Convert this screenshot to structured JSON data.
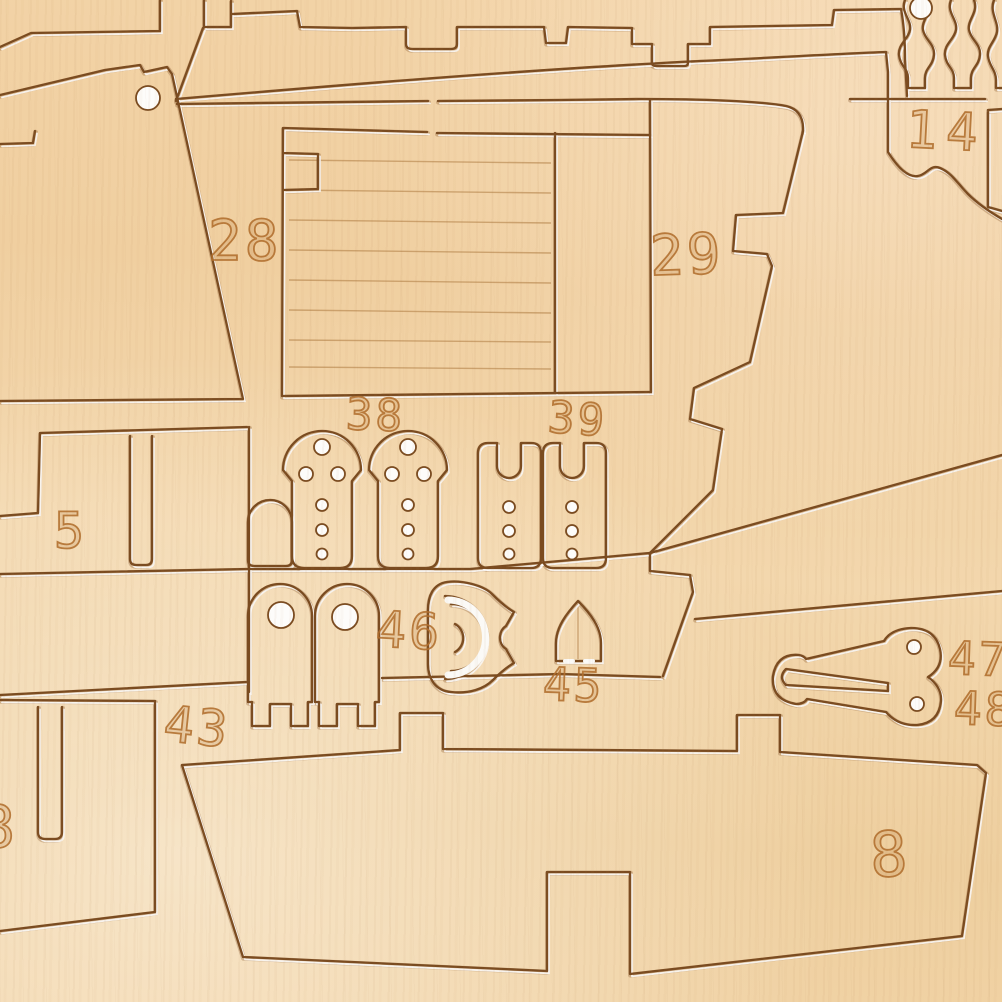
{
  "scene": {
    "description": "Close-up photograph of a laser-cut plywood model ship kit sheet with numbered press-out parts",
    "material": "light birch plywood sheet",
    "colors": {
      "wood": "#f0d1a2",
      "kerf_line": "#7a4b20",
      "kerf_glint": "#ffffff",
      "engraved_number": "#b1702d"
    },
    "features": [
      "finger-jointed deck strips along top edge",
      "planked bulkhead rectangle with scored plank lines",
      "keyhole-shaped parts with pilot holes (38)",
      "slotted rectangular parts with pilot holes (39)",
      "arched parts with large holes",
      "horseshoe-shaped part (46)",
      "pointed-arch part (45)",
      "cleat-shaped part with two holes (47)",
      "large ship deck part with tabs and slot (8)",
      "turned baluster-profile parts at top right"
    ]
  },
  "labels": [
    {
      "part": "part-28",
      "text": "28"
    },
    {
      "part": "part-29",
      "text": "29"
    },
    {
      "part": "part-14",
      "text": "14"
    },
    {
      "part": "part-38",
      "text": "38"
    },
    {
      "part": "part-39",
      "text": "39"
    },
    {
      "part": "part-5",
      "text": "5"
    },
    {
      "part": "part-46",
      "text": "46"
    },
    {
      "part": "part-45",
      "text": "45"
    },
    {
      "part": "part-43",
      "text": "43"
    },
    {
      "part": "part-47",
      "text": "47"
    },
    {
      "part": "part-48",
      "text": "48"
    },
    {
      "part": "part-8",
      "text": "8"
    },
    {
      "part": "part-8-edge-partial",
      "text": "8"
    }
  ]
}
